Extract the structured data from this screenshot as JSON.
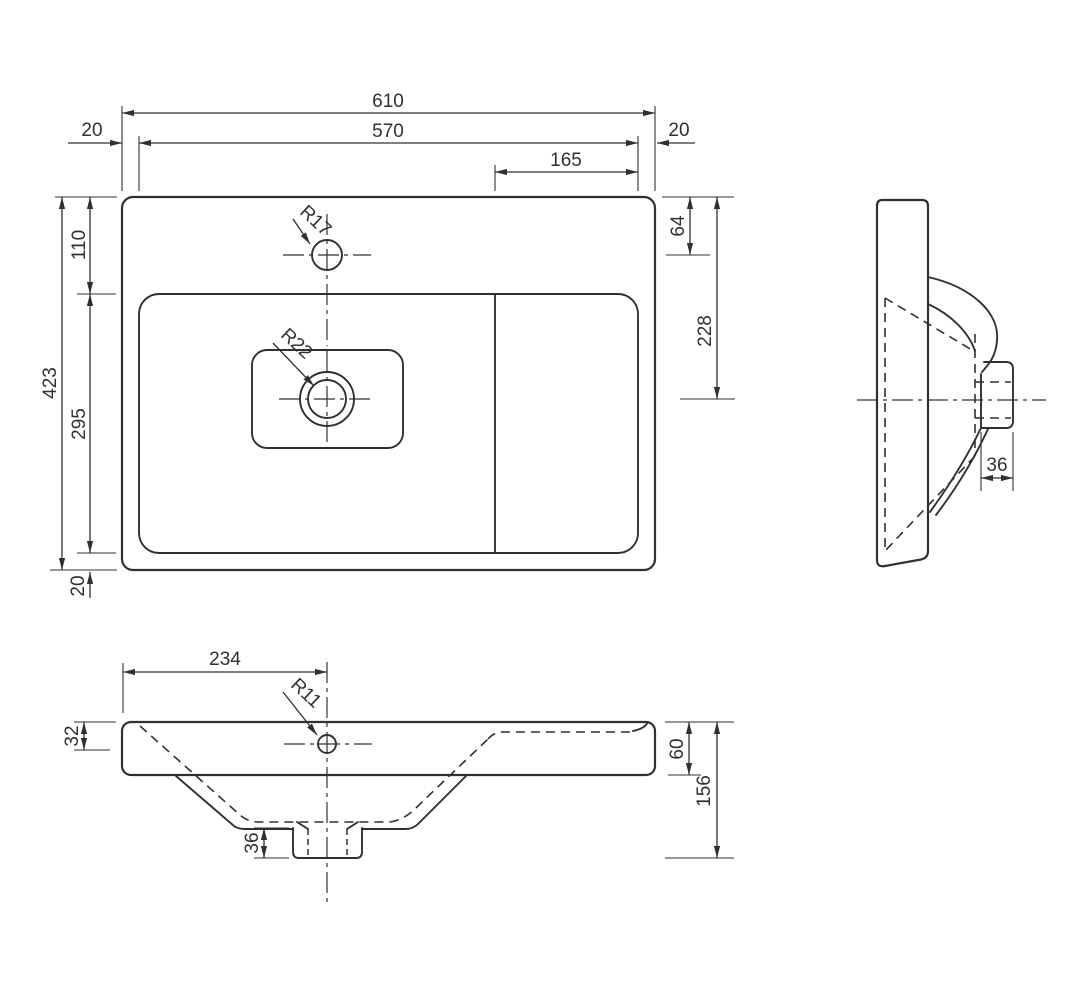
{
  "title": "Washbasin technical drawing - three orthographic views",
  "colors": {
    "line": "#2e3134",
    "background": "#ffffff"
  },
  "dims": {
    "top": {
      "overall_width": "610",
      "basin_width": "570",
      "shelf_width": "165",
      "rim_left": "20",
      "rim_right": "20",
      "overall_depth": "423",
      "basin_top_offset": "110",
      "basin_depth": "295",
      "rim_bottom": "20",
      "faucet_center_offset": "64",
      "drain_center_offset": "228",
      "faucet_hole_radius": "R17",
      "drain_hole_radius": "R22"
    },
    "side": {
      "drain_stub_width": "36"
    },
    "front": {
      "drain_center_from_left": "234",
      "overflow_hole_radius": "R11",
      "rim_thickness": "32",
      "drain_stub_height": "36",
      "apron_height": "60",
      "overall_height": "156"
    }
  }
}
